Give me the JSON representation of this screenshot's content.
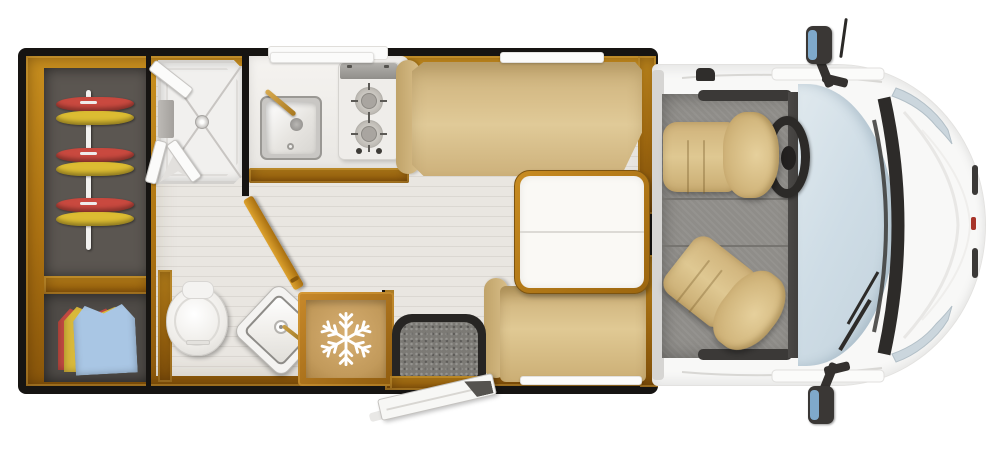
{
  "meta": {
    "title": "Motorhome Floor Plan — Top View",
    "kind": "vehicle-floorplan-diagram"
  },
  "palette": {
    "wood": "#ad7312",
    "wood_dark": "#8a570b",
    "frame_black": "#161412",
    "floor": "#e9e6e1",
    "upholstery_tan": "#d9c08c",
    "cab_floor_gray": "#8f8d89",
    "windshield_blue": "#cfdde6",
    "body_white": "#f8f8f7",
    "wardrobe_gray": "#5b5651",
    "hanger_red": "#c9493f",
    "hanger_yellow": "#dcbc32",
    "clothes_blue": "#a9c6e4",
    "clothes_red": "#c24a42",
    "clothes_yellow": "#d9b93a",
    "mirror_glass_blue": "#7fa9cb",
    "snowflake_white": "#ffffff",
    "badge_red": "#a8352a"
  },
  "legend": {
    "wardrobe": "wardrobe-hanging-rail",
    "storage": "folded-clothes-locker",
    "shower": "shower-cubicle",
    "washroom": "washroom-toilet-and-corner-basin",
    "kitchen": "kitchen-sink-and-two-burner-hob",
    "fridge": "refrigerator",
    "sofa": "lounge-sofa",
    "table": "folding-table",
    "bench": "travel-bench-seat",
    "entry": "entrance-step-and-open-door",
    "cab": "driver-cab",
    "driver_seat": "swivel-driver-seat",
    "passenger_seat": "swivel-passenger-seat",
    "steering": "steering-wheel",
    "windshield": "windshield",
    "mirror": "side-mirror"
  },
  "icons": {
    "fridge": "snowflake-icon"
  },
  "hangers": {
    "colors": [
      "red",
      "yellow",
      "red",
      "yellow",
      "red",
      "yellow"
    ]
  }
}
